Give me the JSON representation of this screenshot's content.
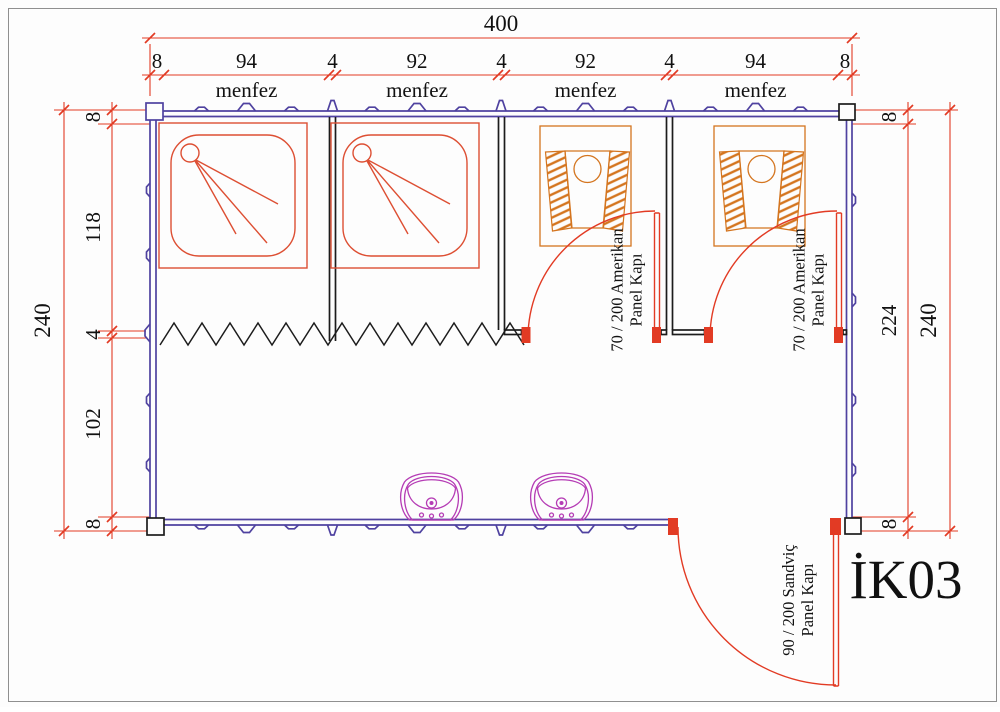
{
  "drawing": {
    "code": "İK03",
    "vent_label": "menfez",
    "dims": {
      "top_total": "400",
      "top_segments": [
        "8",
        "94",
        "4",
        "92",
        "4",
        "92",
        "4",
        "94",
        "8"
      ],
      "left_total": "240",
      "left_segments": [
        "8",
        "118",
        "4",
        "102",
        "8"
      ],
      "right_total": "240",
      "right_segments": [
        "8",
        "224",
        "8"
      ]
    },
    "doors": {
      "wc_line1": "70 / 200 Amerikan",
      "wc_line2": "Panel Kapı",
      "ext_line1": "90 / 200 Sandviç",
      "ext_line2": "Panel Kapı"
    },
    "colors": {
      "dim": "#e23b24",
      "wall": "#4f42a0",
      "shower": "#dd4f33",
      "wc": "#d4751f",
      "sink": "#b53cb5",
      "partition": "#1c1c1c",
      "text": "#111111",
      "border": "#8f8f8f"
    }
  }
}
